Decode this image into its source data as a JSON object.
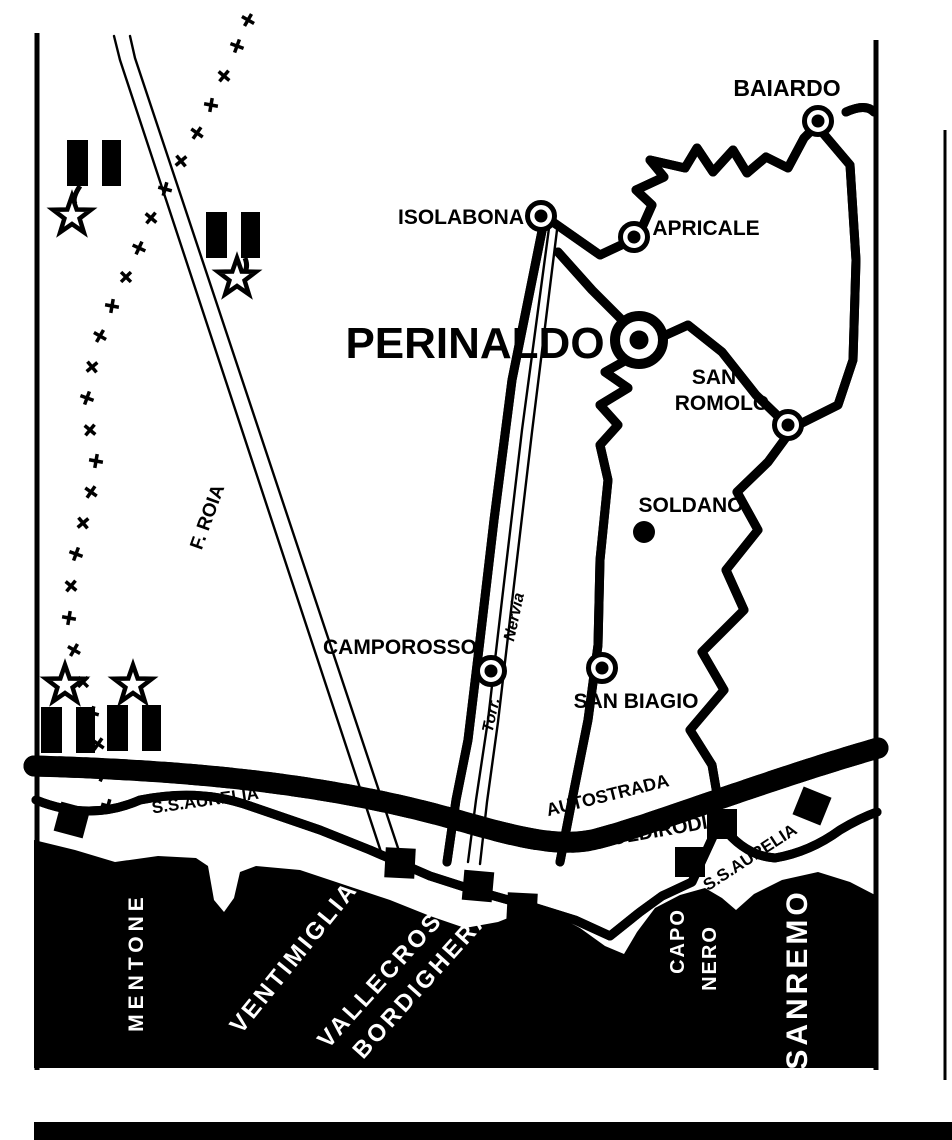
{
  "map": {
    "inland_towns": {
      "baiardo": "BAIARDO",
      "isolabona": "ISOLABONA",
      "apricale": "APRICALE",
      "perinaldo": "PERINALDO",
      "san_romolo_line1": "SAN",
      "san_romolo_line2": "ROMOLO",
      "soldano": "SOLDANO",
      "camporosso": "CAMPOROSSO",
      "san_biagio": "SAN BIAGIO",
      "coldirodi": "COLDIRODI"
    },
    "coastal_towns": {
      "mentone": "MENTONE",
      "ventimiglia": "VENTIMIGLIA",
      "vallecrosia": "VALLECROSIA",
      "bordighera": "BORDIGHERA",
      "capo_nero_line1": "CAPO",
      "capo_nero_line2": "NERO",
      "sanremo": "SANREMO"
    },
    "roads": {
      "aurelia_west": "S.S.AURELIA",
      "autostrada": "AUTOSTRADA",
      "aurelia_east": "S.S.AURELIA"
    },
    "rivers": {
      "roia": "F. ROIA",
      "nervia_abbr": "Torr.",
      "nervia_name": "Nervia"
    }
  },
  "colors": {
    "ink": "#000000",
    "paper": "#ffffff"
  }
}
